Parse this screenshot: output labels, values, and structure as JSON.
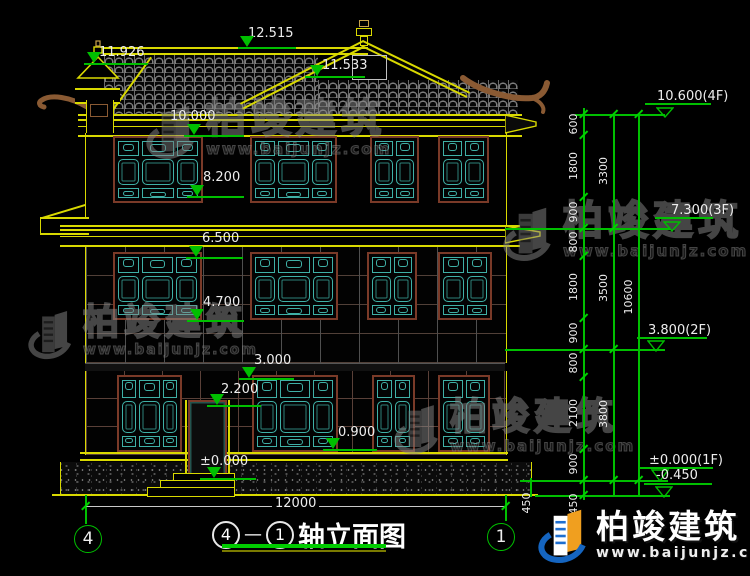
{
  "title": {
    "axis_start": "4",
    "separator": "—",
    "axis_end": "1",
    "label": "轴立面图"
  },
  "brand": {
    "name": "柏竣建筑",
    "url": "www.baijunjz.com"
  },
  "colors": {
    "line_yellow": "#d9d900",
    "line_green": "#00bf00",
    "lattice_teal": "#3fb0a6",
    "frame_maroon": "#7a3a28",
    "logo_blue": "#1565c0",
    "logo_orange": "#f09f1f",
    "underline_green": "#00cc00"
  },
  "elevation_markers": [
    {
      "value": "12.515",
      "tx": 248,
      "ty": 27,
      "trix": 240,
      "lx": 238,
      "ly": 47,
      "lw": 58
    },
    {
      "value": "11.926",
      "tx": 99,
      "ty": 46,
      "trix": 87,
      "lx": 84,
      "ly": 63,
      "lw": 64
    },
    {
      "value": "11.533",
      "tx": 322,
      "ty": 59,
      "trix": 310,
      "lx": 305,
      "ly": 76,
      "lw": 60
    },
    {
      "value": "10.000",
      "tx": 170,
      "ty": 110,
      "trix": 187,
      "lx": 184,
      "ly": 135,
      "lw": 60
    },
    {
      "value": "8.200",
      "tx": 203,
      "ty": 171,
      "trix": 190,
      "lx": 187,
      "ly": 196,
      "lw": 57
    },
    {
      "value": "6.500",
      "tx": 202,
      "ty": 232,
      "trix": 189,
      "lx": 186,
      "ly": 257,
      "lw": 57
    },
    {
      "value": "4.700",
      "tx": 203,
      "ty": 296,
      "trix": 190,
      "lx": 187,
      "ly": 320,
      "lw": 57
    },
    {
      "value": "3.000",
      "tx": 254,
      "ty": 354,
      "trix": 242,
      "lx": 239,
      "ly": 378,
      "lw": 55
    },
    {
      "value": "2.200",
      "tx": 221,
      "ty": 383,
      "trix": 210,
      "lx": 207,
      "ly": 405,
      "lw": 54
    },
    {
      "value": "0.900",
      "tx": 338,
      "ty": 426,
      "trix": 326,
      "lx": 323,
      "ly": 449,
      "lw": 54
    },
    {
      "value": "±0.000",
      "tx": 200,
      "ty": 455,
      "trix": 207,
      "lx": 200,
      "ly": 478,
      "lw": 56
    }
  ],
  "level_markers": [
    {
      "value": "10.600(4F)",
      "tx": 657,
      "ty": 90,
      "trix": 656,
      "lx": 645,
      "ly": 103,
      "lw": 66,
      "level": 114
    },
    {
      "value": "7.300(3F)",
      "tx": 671,
      "ty": 204,
      "trix": 663,
      "lx": 655,
      "ly": 217,
      "lw": 58,
      "level": 228
    },
    {
      "value": "3.800(2F)",
      "tx": 648,
      "ty": 324,
      "trix": 647,
      "lx": 637,
      "ly": 337,
      "lw": 70,
      "level": 349
    },
    {
      "value": "±0.000(1F)",
      "tx": 649,
      "ty": 454,
      "trix": 651,
      "lx": 639,
      "ly": 467,
      "lw": 74,
      "level": 480
    },
    {
      "value": "-0.450",
      "tx": 656,
      "ty": 469,
      "trix": 655,
      "lx": 644,
      "ly": 483,
      "lw": 68,
      "level": 495
    }
  ],
  "dim_chains": [
    {
      "x": 583,
      "y1": 108,
      "y2": 500,
      "ticks": [
        114,
        135,
        197,
        228,
        256,
        318,
        349,
        377,
        449,
        480,
        495
      ],
      "labels": [
        {
          "t": "600",
          "y": 124
        },
        {
          "t": "1800",
          "y": 166
        },
        {
          "t": "900",
          "y": 212
        },
        {
          "t": "800",
          "y": 242
        },
        {
          "t": "1800",
          "y": 287
        },
        {
          "t": "900",
          "y": 333
        },
        {
          "t": "800",
          "y": 363
        },
        {
          "t": "2100",
          "y": 413
        },
        {
          "t": "900",
          "y": 464
        },
        {
          "t": "450",
          "y": 504
        }
      ]
    },
    {
      "x": 613,
      "y1": 114,
      "y2": 497,
      "ticks": [
        114,
        228,
        349,
        480
      ],
      "labels": [
        {
          "t": "3300",
          "y": 171
        },
        {
          "t": "3500",
          "y": 288
        },
        {
          "t": "3800",
          "y": 414
        }
      ]
    },
    {
      "x": 638,
      "y1": 114,
      "y2": 497,
      "ticks": [
        114,
        480
      ],
      "labels": [
        {
          "t": "10600",
          "y": 297
        }
      ]
    }
  ],
  "helper_hlines": [
    {
      "x": 575,
      "y": 114,
      "w": 90
    },
    {
      "x": 505,
      "y": 228,
      "w": 165
    },
    {
      "x": 505,
      "y": 349,
      "w": 160
    },
    {
      "x": 520,
      "y": 480,
      "w": 148
    },
    {
      "x": 535,
      "y": 495,
      "w": 135
    }
  ],
  "helper_vlines": [
    {
      "x": 85,
      "y": 495,
      "h": 29
    },
    {
      "x": 505,
      "y": 495,
      "h": 26
    },
    {
      "x": 530,
      "y": 478,
      "h": 19
    }
  ],
  "extra_labels": [
    {
      "text": "450",
      "x": 521,
      "y": 503
    }
  ],
  "bottom_dim": {
    "label": "12000",
    "x1": 85,
    "x2": 505,
    "y": 506,
    "label_x": 272,
    "label_y": 497
  },
  "axis_bubbles": [
    {
      "label": "4",
      "x": 87,
      "y": 538
    },
    {
      "label": "1",
      "x": 500,
      "y": 536
    }
  ],
  "windows": [
    {
      "x": 113,
      "y": 136,
      "w": 90,
      "h": 67,
      "cols": 3
    },
    {
      "x": 250,
      "y": 136,
      "w": 87,
      "h": 67,
      "cols": 3
    },
    {
      "x": 370,
      "y": 136,
      "w": 49,
      "h": 67,
      "cols": 2
    },
    {
      "x": 438,
      "y": 136,
      "w": 51,
      "h": 67,
      "cols": 2
    },
    {
      "x": 113,
      "y": 252,
      "w": 89,
      "h": 68,
      "cols": 3
    },
    {
      "x": 250,
      "y": 252,
      "w": 88,
      "h": 68,
      "cols": 3
    },
    {
      "x": 367,
      "y": 252,
      "w": 50,
      "h": 68,
      "cols": 2
    },
    {
      "x": 438,
      "y": 252,
      "w": 54,
      "h": 68,
      "cols": 2
    },
    {
      "x": 117,
      "y": 375,
      "w": 65,
      "h": 77,
      "cols": 3
    },
    {
      "x": 252,
      "y": 375,
      "w": 86,
      "h": 77,
      "cols": 3
    },
    {
      "x": 372,
      "y": 375,
      "w": 43,
      "h": 77,
      "cols": 2
    },
    {
      "x": 438,
      "y": 375,
      "w": 52,
      "h": 77,
      "cols": 2
    }
  ],
  "watermarks": [
    {
      "x": 146,
      "y": 98,
      "ts": 40,
      "us": 15
    },
    {
      "x": 28,
      "y": 304,
      "ts": 36,
      "us": 14
    },
    {
      "x": 503,
      "y": 200,
      "ts": 40,
      "us": 15
    },
    {
      "x": 394,
      "y": 398,
      "ts": 37,
      "us": 15
    }
  ]
}
